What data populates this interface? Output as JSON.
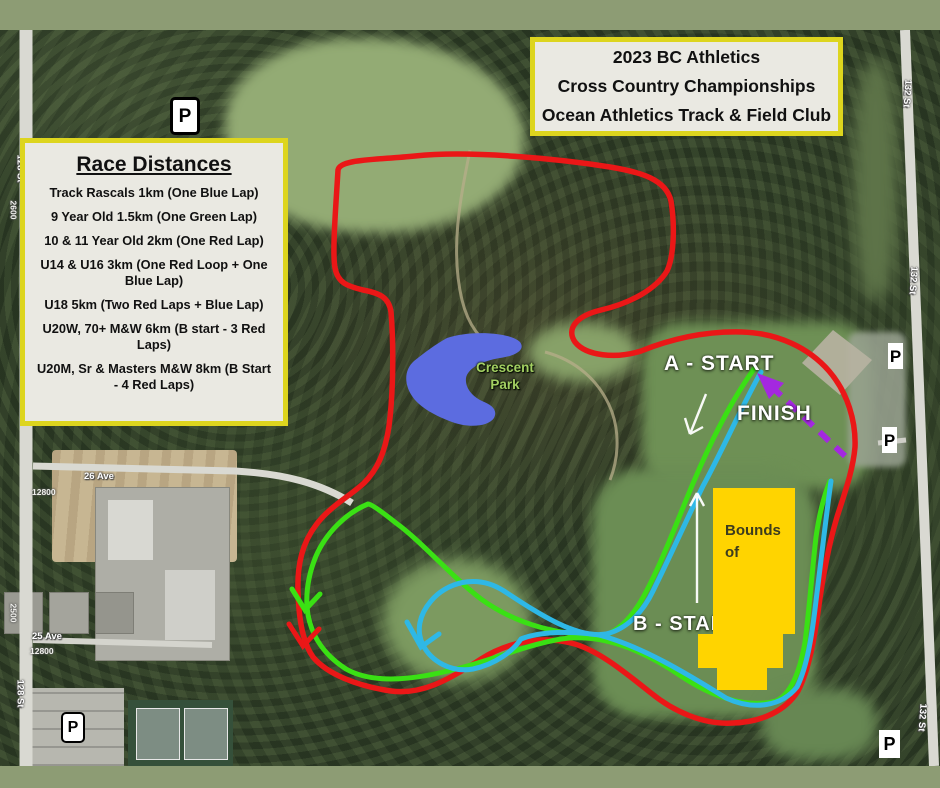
{
  "title_box": {
    "lines": [
      "2023 BC Athletics",
      "Cross Country Championships",
      "Ocean Athletics Track & Field Club"
    ]
  },
  "legend": {
    "title": "Race Distances",
    "items": [
      "Track Rascals  1km (One Blue Lap)",
      "9 Year Old 1.5km (One Green Lap)",
      "10 & 11 Year Old 2km (One Red Lap)",
      "U14 & U16 3km (One Red Loop + One Blue Lap)",
      "U18 5km (Two Red Laps + Blue Lap)",
      "U20W, 70+ M&W 6km (B start - 3 Red Laps)",
      "U20M, Sr & Masters M&W 8km (B Start - 4 Red Laps)"
    ]
  },
  "map": {
    "labels": {
      "a_start": "A - START",
      "finish": "FINISH",
      "b_start": "B - START"
    },
    "out_of_bounds": {
      "line1": "Out of",
      "line2": "Bounds"
    },
    "park": {
      "line1": "Crescent",
      "line2": "Park"
    },
    "parking": "P",
    "streets": {
      "st_128": "128 St",
      "st_132": "132 St",
      "ave_26": "26 Ave",
      "ave_25": "25 Ave"
    },
    "addresses": {
      "a_12800": "12800",
      "a_2600": "2600",
      "a_2500": "2500"
    },
    "colors": {
      "red_course": "#ea1717",
      "green_course": "#3ae014",
      "blue_course": "#2eb8e6",
      "finish_arrow": "#a428e0",
      "out_of_bounds": "#ffd400",
      "box_border": "#ddd51e",
      "box_bg": "#eae9e2",
      "lake": "#5c6ce0",
      "band": "#8d9c74"
    }
  }
}
